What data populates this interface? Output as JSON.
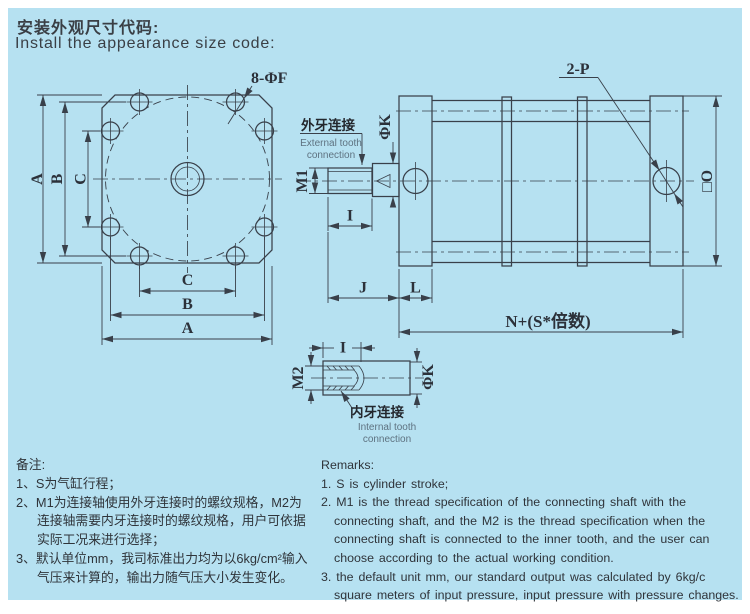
{
  "title": {
    "zh": "安装外观尺寸代码:",
    "en": "Install the appearance size code:"
  },
  "front_view": {
    "hole_label": "8-ΦF",
    "dim_a": "A",
    "dim_b": "B",
    "dim_c": "C"
  },
  "external_conn": {
    "label_zh": "外牙连接",
    "label_en_line1": "External tooth",
    "label_en_line2": "connection",
    "dim_m1": "M1",
    "dim_phik": "ΦK",
    "dim_i": "I",
    "dim_j": "J",
    "dim_l": "L"
  },
  "side_view": {
    "port_label": "2-P",
    "square_label": "□O",
    "length_label": "N+(S*倍数)"
  },
  "internal_conn": {
    "label_zh": "内牙连接",
    "label_en_line1": "Internal tooth",
    "label_en_line2": "connection",
    "dim_m2": "M2",
    "dim_phik": "ΦK",
    "dim_i": "I"
  },
  "remarks_zh": {
    "heading": "备注:",
    "lines": [
      "1、S为气缸行程；",
      "2、M1为连接轴使用外牙连接时的螺纹规格，M2为",
      "连接轴需要内牙连接时的螺纹规格，用户可依据",
      "实际工况来进行选择；",
      "3、默认单位mm，我司标准出力均为以6kg/cm²输入",
      "气压来计算的，输出力随气压大小发生变化。"
    ]
  },
  "remarks_en": {
    "heading": "Remarks:",
    "lines": [
      "1. S is cylinder stroke;",
      "2. M1 is the thread specification of the connecting shaft with the",
      "connecting shaft, and the M2 is the thread specification when the",
      "connecting shaft is connected to the inner tooth, and the user can",
      "choose according to the actual working condition.",
      "3. the default unit mm, our standard output was calculated by 6kg/c",
      "square meters of input pressure, input pressure with pressure changes."
    ]
  }
}
